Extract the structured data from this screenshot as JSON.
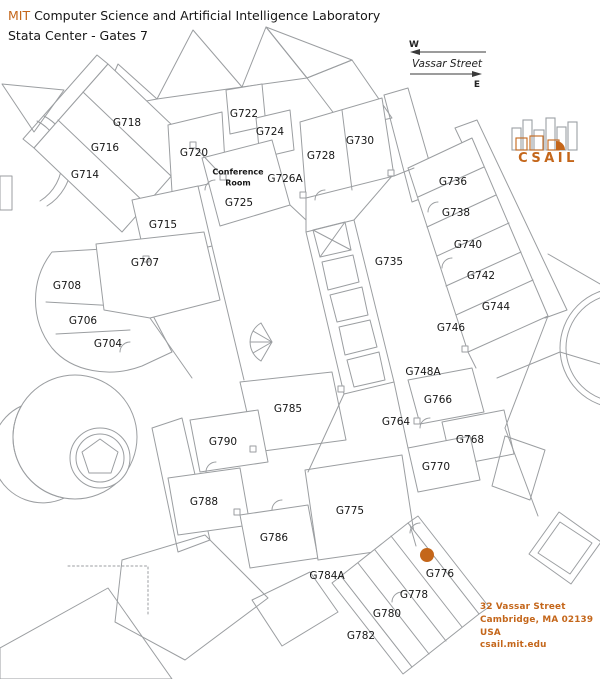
{
  "header": {
    "org_prefix": "MIT",
    "org_rest": " Computer Science and Artificial Intelligence Laboratory",
    "subtitle": "Stata Center - Gates 7"
  },
  "compass": {
    "west": "W",
    "east": "E",
    "street": "Vassar Street"
  },
  "logo": {
    "text": "CSAIL"
  },
  "address": {
    "lines": [
      "32 Vassar Street",
      "Cambridge, MA 02139",
      "USA",
      "csail.mit.edu"
    ]
  },
  "colors": {
    "accent": "#C4661A",
    "marker": "#C4661A",
    "wall": "#9b9ea1",
    "hatch": "#b3b5b7"
  },
  "marker": {
    "x": 427,
    "y": 555,
    "r": 7,
    "room": "G776"
  },
  "rooms": [
    {
      "label": "G718",
      "x": 127,
      "y": 123
    },
    {
      "label": "G716",
      "x": 105,
      "y": 148
    },
    {
      "label": "G714",
      "x": 85,
      "y": 175
    },
    {
      "label": "G720",
      "x": 194,
      "y": 153
    },
    {
      "label": "G722",
      "x": 244,
      "y": 114
    },
    {
      "label": "G724",
      "x": 270,
      "y": 132
    },
    {
      "label": "Conference",
      "x": 238,
      "y": 172,
      "fs": 8,
      "bold": true
    },
    {
      "label": "Room",
      "x": 238,
      "y": 183,
      "fs": 8,
      "bold": true
    },
    {
      "label": "G725",
      "x": 239,
      "y": 203
    },
    {
      "label": "G726A",
      "x": 285,
      "y": 179
    },
    {
      "label": "G728",
      "x": 321,
      "y": 156
    },
    {
      "label": "G730",
      "x": 360,
      "y": 141
    },
    {
      "label": "G736",
      "x": 453,
      "y": 182
    },
    {
      "label": "G738",
      "x": 456,
      "y": 213
    },
    {
      "label": "G740",
      "x": 468,
      "y": 245
    },
    {
      "label": "G742",
      "x": 481,
      "y": 276
    },
    {
      "label": "G744",
      "x": 496,
      "y": 307
    },
    {
      "label": "G746",
      "x": 451,
      "y": 328
    },
    {
      "label": "G735",
      "x": 389,
      "y": 262
    },
    {
      "label": "G715",
      "x": 163,
      "y": 225
    },
    {
      "label": "G707",
      "x": 145,
      "y": 263
    },
    {
      "label": "G708",
      "x": 67,
      "y": 286
    },
    {
      "label": "G706",
      "x": 83,
      "y": 321
    },
    {
      "label": "G704",
      "x": 108,
      "y": 344
    },
    {
      "label": "G748A",
      "x": 423,
      "y": 372
    },
    {
      "label": "G766",
      "x": 438,
      "y": 400
    },
    {
      "label": "G764",
      "x": 396,
      "y": 422
    },
    {
      "label": "G768",
      "x": 470,
      "y": 440
    },
    {
      "label": "G770",
      "x": 436,
      "y": 467
    },
    {
      "label": "G785",
      "x": 288,
      "y": 409
    },
    {
      "label": "G790",
      "x": 223,
      "y": 442
    },
    {
      "label": "G788",
      "x": 204,
      "y": 502
    },
    {
      "label": "G786",
      "x": 274,
      "y": 538
    },
    {
      "label": "G775",
      "x": 350,
      "y": 511
    },
    {
      "label": "G784A",
      "x": 327,
      "y": 576
    },
    {
      "label": "G776",
      "x": 440,
      "y": 574
    },
    {
      "label": "G778",
      "x": 414,
      "y": 595
    },
    {
      "label": "G780",
      "x": 387,
      "y": 614
    },
    {
      "label": "G782",
      "x": 361,
      "y": 636
    }
  ]
}
